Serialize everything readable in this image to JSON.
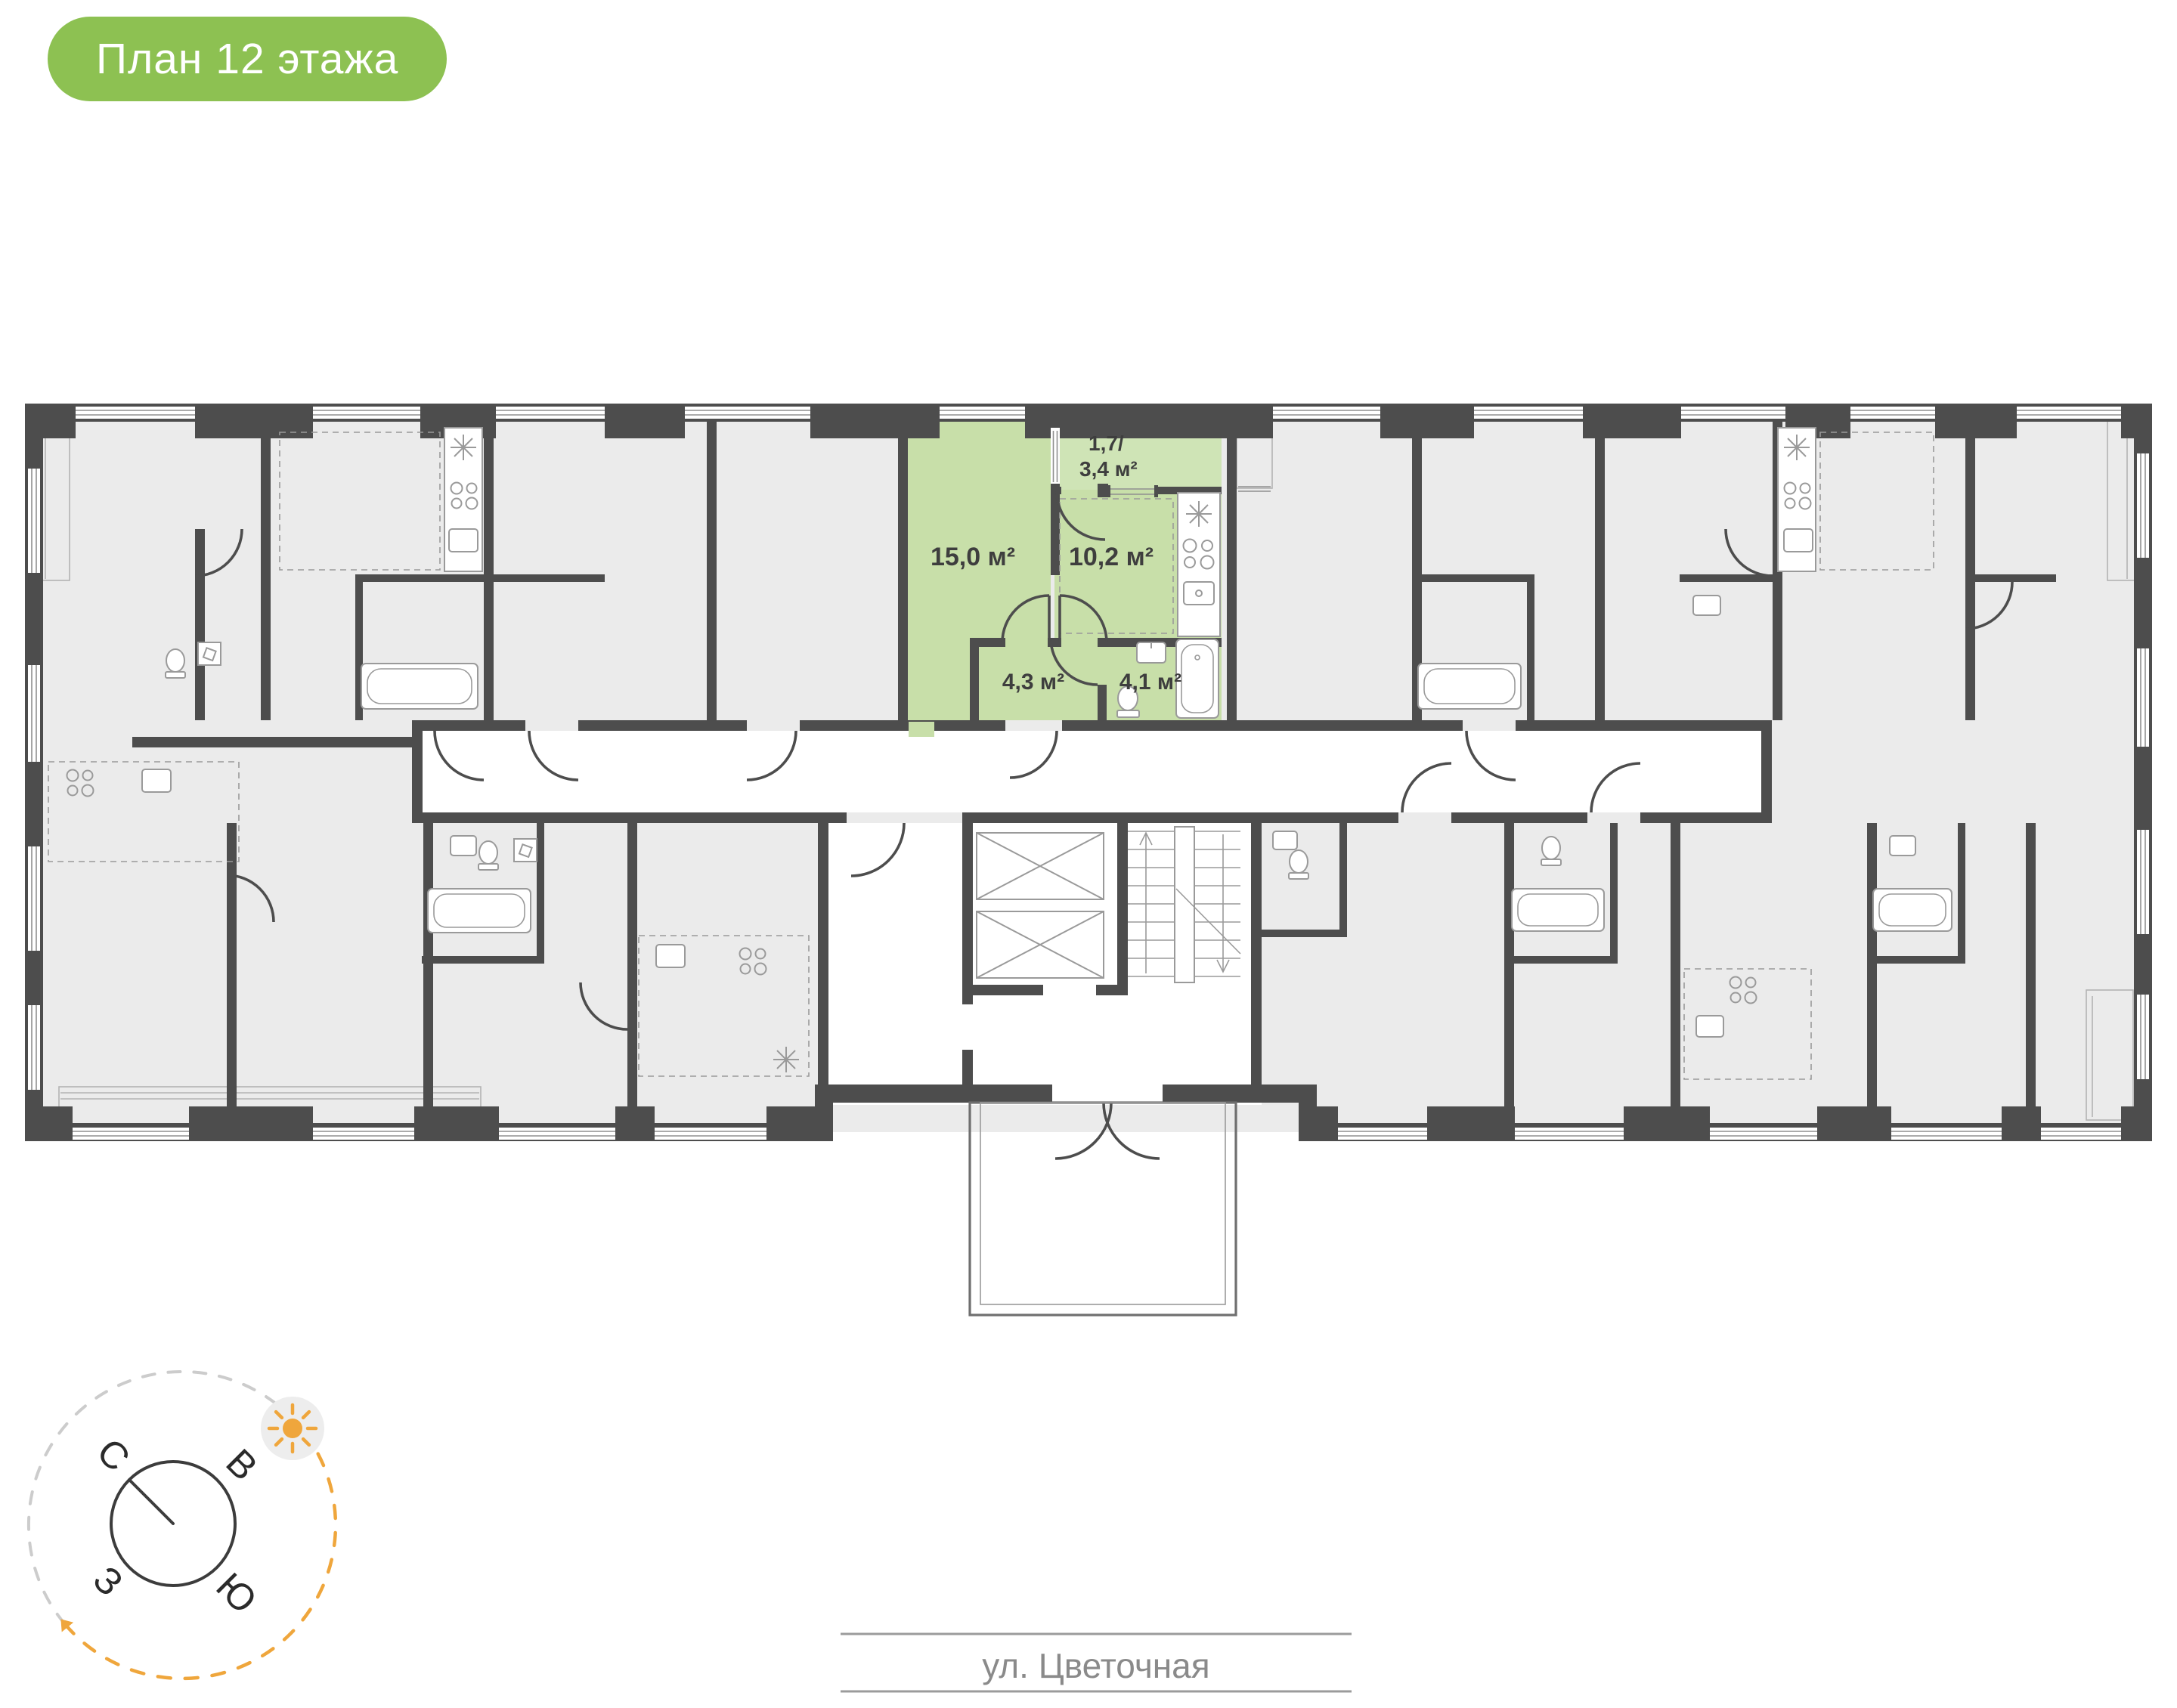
{
  "badge": {
    "label": "План 12 этажа"
  },
  "plan": {
    "apartment": {
      "status": "highlighted",
      "rooms": {
        "living": {
          "area": "15,0 м²"
        },
        "kitchen": {
          "area": "10,2 м²"
        },
        "hallway": {
          "area": "4,3 м²"
        },
        "bathroom": {
          "area": "4,1 м²"
        },
        "balcony": {
          "area_line1": "1,7/",
          "area_line2": "3,4 м²"
        }
      }
    }
  },
  "compass": {
    "north": "С",
    "east": "В",
    "west": "З",
    "south": "Ю"
  },
  "street": {
    "label": "ул. Цветочная"
  },
  "colors": {
    "badge_green": "#8dc152",
    "highlight_green": "#c8dfa9",
    "balcony_green": "#cfe4b6",
    "wall_gray": "#4d4d4d",
    "room_gray": "#ebebeb",
    "sun_orange": "#efa63c"
  }
}
